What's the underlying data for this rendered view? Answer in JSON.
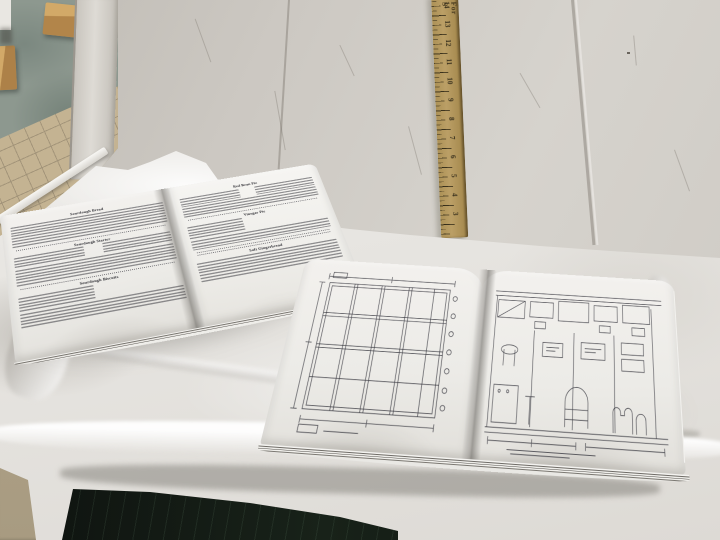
{
  "scene": {
    "description": "Photograph: two open booklets on a work table covered with crumpled white paper, a wooden yardstick leaning against a scuffed white wall, teal painted floor with tan tiles and wood blocks visible at left, dark table front below"
  },
  "colors": {
    "wall": "#cdc9c3",
    "cloth": "#ebe9e5",
    "page": "#f0eeea",
    "ink": "#3e3e45",
    "ruler_wood": "#b39859",
    "floor_teal": "#8d988f",
    "tile_tan": "#c4b392",
    "wood_block": "#c09a5c",
    "table_front": "#121713",
    "floor_strip": "#b0a388"
  },
  "ruler": {
    "brand_fragment": "For S",
    "numbers": [
      "14",
      "13",
      "12",
      "11",
      "10",
      "9",
      "8",
      "7",
      "6",
      "5",
      "4",
      "3"
    ]
  },
  "left_booklet": {
    "description": "Open booklet of old-fashioned recipe pages with dotted rule separators",
    "pages": [
      {
        "sections": [
          {
            "heading": "Sourdough Bread"
          },
          {
            "heading": "Sourdough Starter"
          },
          {
            "heading": "Sourdough Biscuits"
          }
        ]
      },
      {
        "sections": [
          {
            "heading": "Red Bean Pie"
          },
          {
            "heading": "Vinegar Pie"
          },
          {
            "heading": "Soft Gingerbread"
          }
        ]
      }
    ]
  },
  "right_booklet": {
    "description": "Open booklet of measured drawings",
    "left_page_drawing": "wall framing elevation with studs, rails and dimension lines",
    "right_page_drawing": "store interior elevation with shelving, counters, display case and grave-marker shapes, underlined title below"
  }
}
